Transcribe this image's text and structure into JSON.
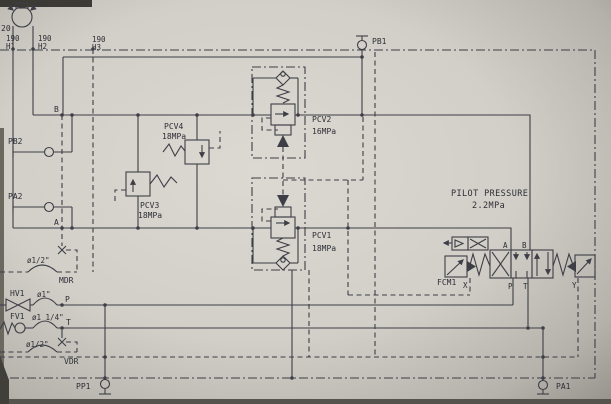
{
  "diagram": {
    "pump_label": "20",
    "hose_tags": [
      {
        "size": "190",
        "id": "H1"
      },
      {
        "size": "190",
        "id": "H2"
      },
      {
        "size": "190",
        "id": "H3"
      }
    ],
    "line_labels": {
      "b": "B",
      "a": "A",
      "p": "P",
      "t": "T"
    },
    "ports": {
      "pb1": "PB1",
      "pb2": "PB2",
      "pa1": "PA1",
      "pa2": "PA2",
      "pp1": "PP1"
    },
    "relief_valves": {
      "pcv1": {
        "name": "PCV1",
        "setting": "18MPa"
      },
      "pcv2": {
        "name": "PCV2",
        "setting": "16MPa"
      },
      "pcv3": {
        "name": "PCV3",
        "setting": "18MPa"
      },
      "pcv4": {
        "name": "PCV4",
        "setting": "18MPa"
      }
    },
    "pilot_pressure": {
      "title": "PILOT PRESSURE",
      "value": "2.2MPa"
    },
    "control_valve": {
      "name": "FCM1",
      "ports": {
        "a": "A",
        "b": "B",
        "p": "P",
        "t": "T",
        "x": "X",
        "y": "Y"
      }
    },
    "fittings": {
      "hv1": {
        "name": "HV1",
        "size": "ø1\""
      },
      "fv1": {
        "name": "FV1",
        "size": "ø1 1/4\""
      },
      "mdr": {
        "name": "MDR",
        "size": "ø1/2\""
      },
      "vdr": {
        "name": "VDR",
        "size": "ø1/2\""
      }
    }
  }
}
